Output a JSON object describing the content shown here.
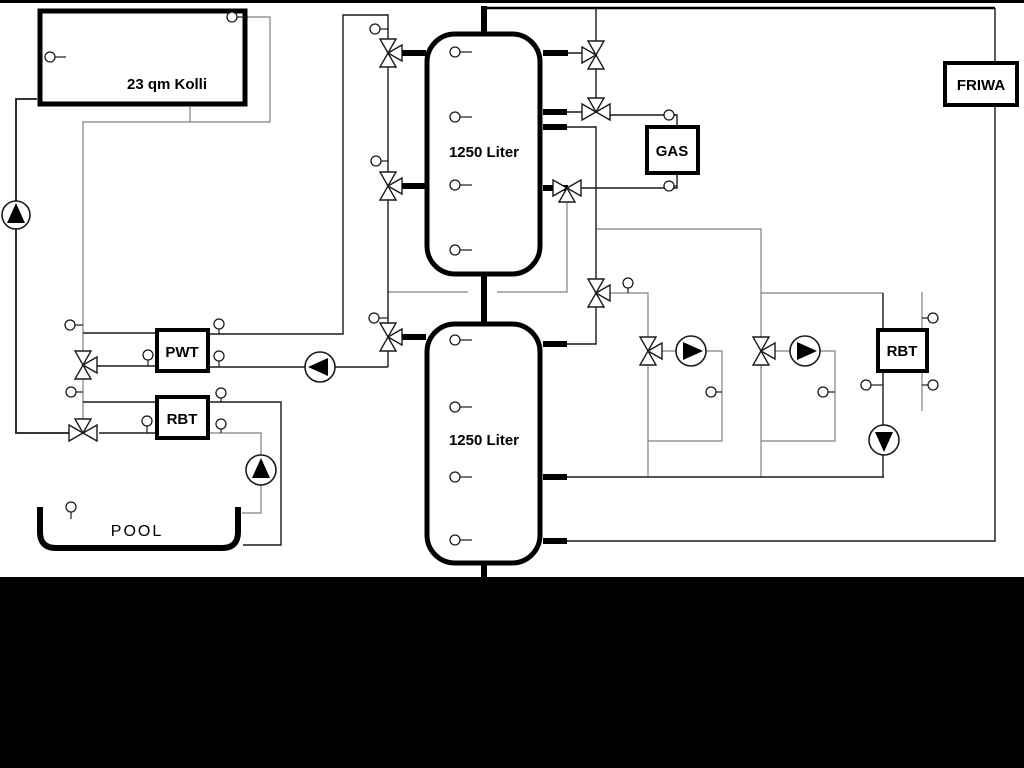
{
  "diagram": {
    "labels": {
      "collector": "23 qm Kolli",
      "upper_tank": "1250 Liter",
      "lower_tank": "1250 Liter",
      "heat_exchanger": "PWT",
      "pool_return_unit": "RBT",
      "boiler": "GAS",
      "fresh_water_station": "FRIWA",
      "right_return_unit": "RBT",
      "pool": "POOL"
    },
    "colors": {
      "background": "#ffffff",
      "line_dark": "#1a1a1a",
      "line_gray": "#808080",
      "component_border": "#000000",
      "footer_band": "#000000"
    }
  }
}
